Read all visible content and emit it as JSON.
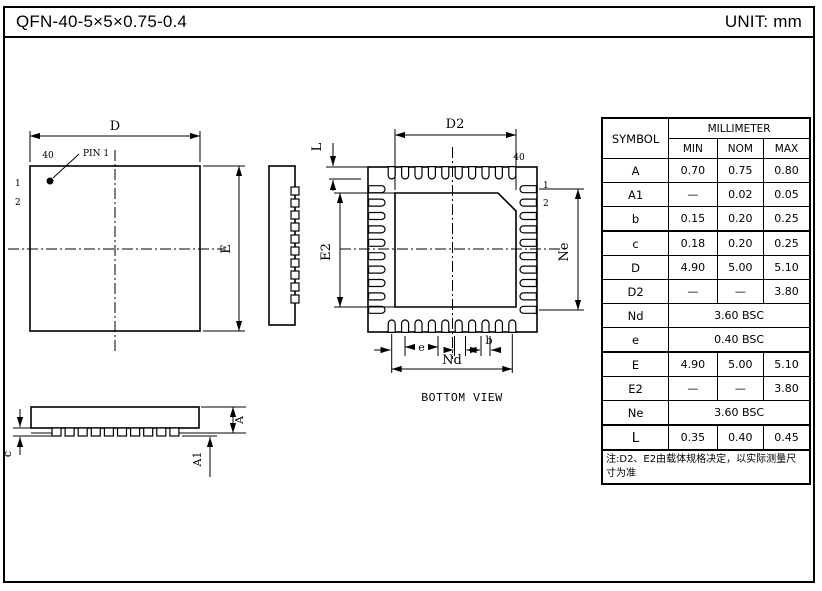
{
  "header": {
    "title": "QFN-40-5×5×0.75-0.4",
    "unit": "UNIT: mm"
  },
  "labels": {
    "d": "D",
    "e_cap": "E",
    "d2": "D2",
    "e2": "E2",
    "l": "L",
    "ne": "Ne",
    "nd": "Nd",
    "pitch": "e",
    "b": "b",
    "n40": "40",
    "n1": "1",
    "n2": "2",
    "pin1": "PIN 1",
    "a": "A",
    "a1": "A1",
    "c": "c",
    "bottom_view": "BOTTOM VIEW"
  },
  "table": {
    "header": {
      "symbol": "SYMBOL",
      "group": "MILLIMETER",
      "min": "MIN",
      "nom": "NOM",
      "max": "MAX"
    },
    "rows": [
      {
        "symbol": "A",
        "min": "0.70",
        "nom": "0.75",
        "max": "0.80"
      },
      {
        "symbol": "A1",
        "min": "—",
        "nom": "0.02",
        "max": "0.05"
      },
      {
        "symbol": "b",
        "min": "0.15",
        "nom": "0.20",
        "max": "0.25"
      },
      {
        "symbol": "c",
        "min": "0.18",
        "nom": "0.20",
        "max": "0.25"
      },
      {
        "symbol": "D",
        "min": "4.90",
        "nom": "5.00",
        "max": "5.10"
      },
      {
        "symbol": "D2",
        "min": "—",
        "nom": "—",
        "max": "3.80"
      },
      {
        "symbol": "Nd",
        "bsc": "3.60 BSC"
      },
      {
        "symbol": "e",
        "bsc": "0.40 BSC"
      },
      {
        "symbol": "E",
        "min": "4.90",
        "nom": "5.00",
        "max": "5.10"
      },
      {
        "symbol": "E2",
        "min": "—",
        "nom": "—",
        "max": "3.80"
      },
      {
        "symbol": "Ne",
        "bsc": "3.60 BSC"
      },
      {
        "symbol": "L",
        "min": "0.35",
        "nom": "0.40",
        "max": "0.45"
      }
    ],
    "note": "注:D2、E2由载体规格决定，以实际测量尺寸为准"
  }
}
